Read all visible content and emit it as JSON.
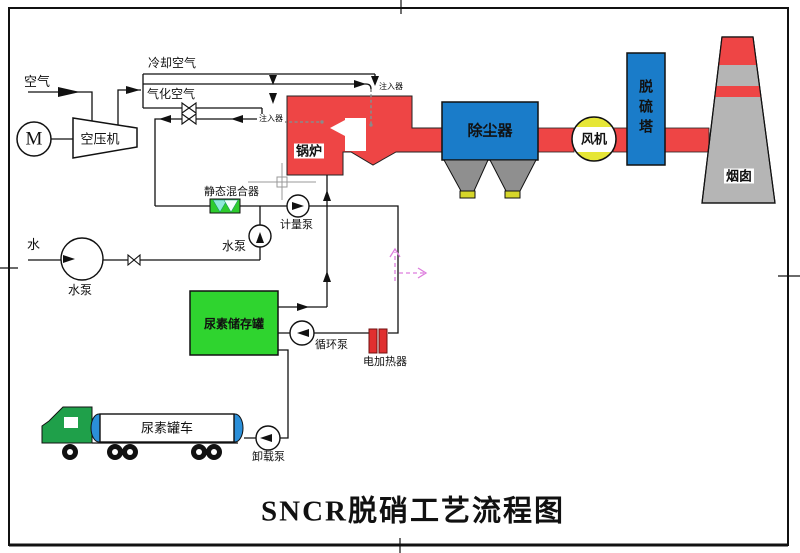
{
  "title": {
    "text": "SNCR脱硝工艺流程图"
  },
  "air_system": {
    "air_label": "空气",
    "motor_label": "M",
    "compressor_label": "空压机",
    "cooling_air_label": "冷却空气",
    "gasification_air_label": "气化空气"
  },
  "injection": {
    "injector_top_label": "注入器",
    "injector_left_label": "注入器"
  },
  "flue_gas_train": {
    "boiler_label": "锅炉",
    "dust_collector_label": "除尘器",
    "fan_label": "风机",
    "desulfurization_tower_label": "脱硫塔",
    "chimney_label": "烟囱"
  },
  "urea_system": {
    "static_mixer_label": "静态混合器",
    "metering_pump_label": "计量泵",
    "urea_storage_tank_label": "尿素储存罐",
    "circulation_pump_label": "循环泵",
    "electric_heater_label": "电加热器",
    "urea_tank_truck_label": "尿素罐车",
    "unloading_pump_label": "卸载泵"
  },
  "water_system": {
    "water_label": "水",
    "water_pump_label": "水泵",
    "water_feed_pump_label": "水泵"
  },
  "colors": {
    "flue_red": "#ee4545",
    "equipment_blue": "#1a7cc9",
    "tank_green": "#2fd42f",
    "mixer_green": "#2ecc2e",
    "cab_green": "#1fa04a",
    "fan_yellow": "#e6e636",
    "hopper_gray": "#8f8f8f",
    "chimney_gray": "#b5b5b5",
    "heater_red": "#e03030",
    "truck_cap_blue": "#2b8fd9",
    "hopper_foot_yellow": "#d6d62a",
    "markup_pink": "#dd7ddd"
  }
}
